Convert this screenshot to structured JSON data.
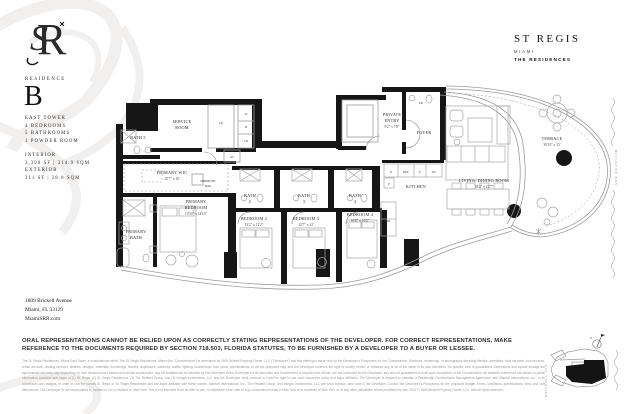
{
  "brand": {
    "name": "ST REGIS",
    "city": "MIAMI",
    "sub": "THE RESIDENCES",
    "monogram": {
      "letter_s": "S",
      "letter_r": "R"
    }
  },
  "residence": {
    "label": "RESIDENCE",
    "letter": "B",
    "specs": "EAST TOWER\n4 BEDROOMS\n5 BATHROOMS\n1 POWDER ROOM",
    "area": "INTERIOR\n3,390 SF | 314.9 SQM\nEXTERIOR\n311 SF | 28.8 SQM"
  },
  "address": {
    "line1": "1809 Brickell Avenue",
    "line2": "Miami, FL 33129",
    "line3": "MiamiSRR.com"
  },
  "plan": {
    "labels": {
      "bath5": "BATH 5",
      "service1": "SERVICE",
      "service2": "ROOM",
      "lr": "LR",
      "w": "W",
      "d": "D",
      "ln": "LN",
      "ac": "AC",
      "private1": "PRIVATE",
      "private2": "ENTRY",
      "private_dims": "9'2\" x 7'8\"",
      "pr": "PR",
      "foyer": "FOYER",
      "wic": "PRIMARY WIC",
      "wic_dims": "20'7\" x 10'",
      "midnight1": "MIDNIGHT",
      "midnight2": "BAR",
      "pbr1": "PRIMARY",
      "pbr2": "BEDROOM",
      "pbr_dims": "19'10\" x 14'10\"",
      "pbath1": "PRIMARY",
      "pbath2": "BATH",
      "bath2a": "BATH",
      "bath2b": "2",
      "br2": "BEDROOM 2",
      "br2_dims": "13'2\" x 12'2\"",
      "bath3a": "BATH",
      "bath3b": "3",
      "br3": "BEDROOM 3",
      "br3_dims": "12'7\" x 12'",
      "bath4a": "BATH",
      "bath4b": "4",
      "br4": "BEDROOM 4",
      "br4_dims": "10'8\" x 10'2\"",
      "kitchen": "KITCHEN",
      "o": "O",
      "ref": "REF",
      "f": "F",
      "wc": "WC",
      "p": "P",
      "dw": "DW",
      "living": "LIVING/ DINING ROOM",
      "living_dims": "33'4\" x 21'7\"",
      "terrace": "TERRACE",
      "terrace_dims": "30'10\" x 12'"
    }
  },
  "map": {
    "street": "BRICKELL AVE",
    "bay": "BISCAYNE BAY",
    "north": "N"
  },
  "disclaimer": {
    "bold": "ORAL REPRESENTATIONS CANNOT BE RELIED UPON AS CORRECTLY STATING REPRESENTATIONS OF THE DEVELOPER. FOR CORRECT REPRESENTATIONS, MAKE REFERENCE TO THE DOCUMENTS REQUIRED BY SECTION 718.503, FLORIDA STATUTES, TO BE FURNISHED BY A DEVELOPER TO A BUYER OR LESSEE.",
    "fine": "The St. Regis Residences, Miami East Tower, a condominium within The St. Regis Residences, Miami (the \"Condominium\") is developed by 1809 Brickell Property Owner, LLC (\"Developer\") and this offering is made only by the Developer's Prospectus for the Condominium. Sketches, renderings, or photographs depicting lifestyle, amenities, food services, club services, rental services, hosting services, finishes, designs, materials, furnishings, fixtures, appliances, cabinetry, soffits, lighting, countertops, floor plans, specifications, or art are proposed only, and the Developer reserves the right to modify, revise, or withdraw any or all of the same in its sole discretion. No specific view is guaranteed. Dimensions and square footage are approximate and may vary depending on how measured and based upon actual construction. Any art installed will be selected by the Developer at the Developer's sole discretion and if referenced or depicted are off-site, are not controlled by the Developer, and are not guaranteed to exist upon completion of the Condominium. All statistics referenced are based on public information available and logos of (1) St. Regis, (2) St. Regis Residences, (3) The Related Group, and (3) Integra Investments, LLC and the Developer shall continue to have the right to use each respective name and logos affiliated. The Developer is required to maintain a Residential Condominium Management Agreement with Marriott International, Inc., or its successors and assigns, in order to use the names St. Regis or St. Regis Residences and the logos affiliated with these names. Marriott International, Inc., The Related Group, and Integra Investments, LLC are each licensor, and none is the Developer. Consult the Developer's Prospectus for the proposed budget, terms, conditions, specifications, fees, and Unit dimensions. The Developer is not incorporated in, located in, nor a resident of, New York. This is not intended to be an offer to sell, or solicitation of an offer to buy, condominium units in New York or to residents of New York, or of any other jurisdiction where prohibited by law. 2022 © 1809 Brickell Property Owner, LLC, with all rights reserved."
  }
}
